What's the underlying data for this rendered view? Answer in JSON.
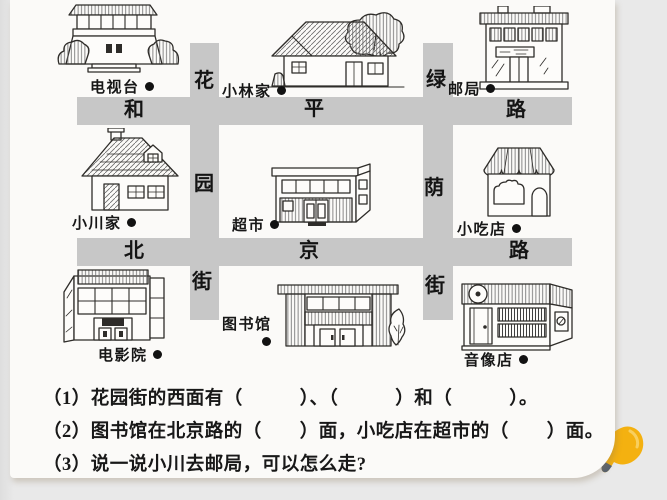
{
  "colors": {
    "background": "#e9e9e9",
    "sheet": "#fbfaf8",
    "street": "#c7c7c7",
    "ink": "#1a1a1a",
    "pin_yellow": "#f4b110"
  },
  "map": {
    "streets": {
      "horizontal": [
        {
          "name": "和平路",
          "chars": [
            "和",
            "平",
            "路"
          ]
        },
        {
          "name": "北京路",
          "chars": [
            "北",
            "京",
            "路"
          ]
        }
      ],
      "vertical": [
        {
          "name": "花园街",
          "chars": [
            "花",
            "园",
            "街"
          ]
        },
        {
          "name": "绿荫街",
          "chars": [
            "绿",
            "荫",
            "街"
          ]
        }
      ]
    },
    "places": [
      {
        "id": "tv-station",
        "label": "电视台"
      },
      {
        "id": "xiaolin-home",
        "label": "小林家"
      },
      {
        "id": "post-office",
        "label": "邮局"
      },
      {
        "id": "xiaochuan-home",
        "label": "小川家"
      },
      {
        "id": "supermarket",
        "label": "超市"
      },
      {
        "id": "snack-shop",
        "label": "小吃店"
      },
      {
        "id": "cinema",
        "label": "电影院"
      },
      {
        "id": "library",
        "label": "图书馆"
      },
      {
        "id": "av-store",
        "label": "音像店"
      }
    ]
  },
  "questions": [
    "（1）花园街的西面有（　　　）、（　　　）和（　　　）。",
    "（2）图书馆在北京路的（　　）面，小吃店在超市的（　　）面。",
    "（3）说一说小川去邮局，可以怎么走?"
  ]
}
